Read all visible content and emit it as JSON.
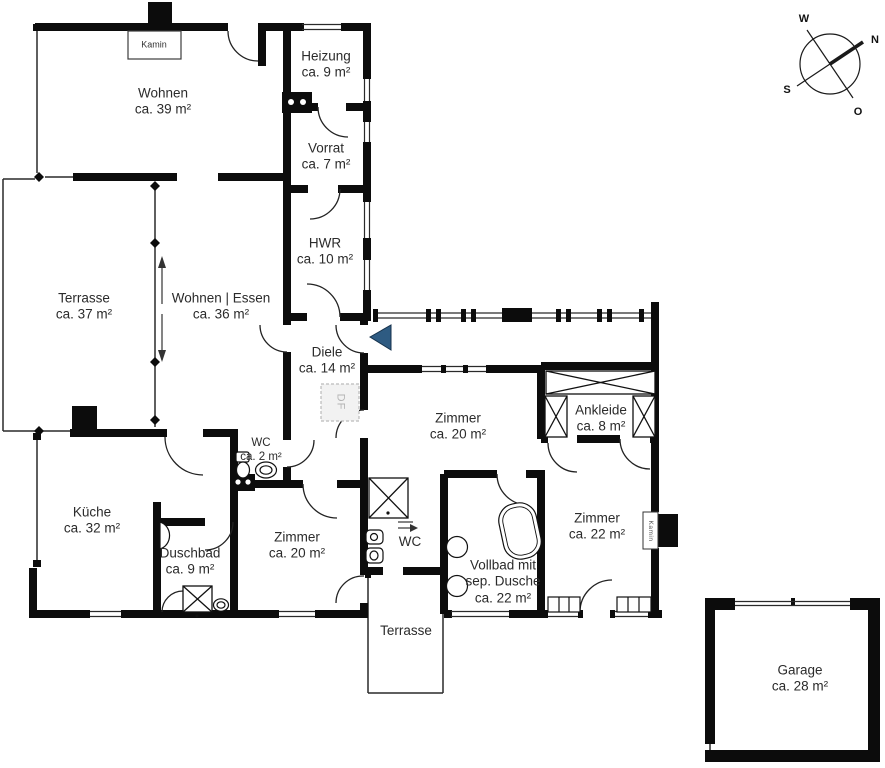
{
  "plan": {
    "compass": {
      "w": "W",
      "n": "N",
      "s": "S",
      "o": "O"
    },
    "rooms": {
      "wohnen": {
        "name": "Wohnen",
        "area": "ca. 39 m²"
      },
      "heizung": {
        "name": "Heizung",
        "area": "ca. 9 m²"
      },
      "vorrat": {
        "name": "Vorrat",
        "area": "ca. 7 m²"
      },
      "hwr": {
        "name": "HWR",
        "area": "ca. 10 m²"
      },
      "terrasse_links": {
        "name": "Terrasse",
        "area": "ca. 37 m²"
      },
      "wohnen_essen": {
        "name": "Wohnen | Essen",
        "area": "ca. 36 m²"
      },
      "diele": {
        "name": "Diele",
        "area": "ca. 14 m²"
      },
      "zimmer_mitte": {
        "name": "Zimmer",
        "area": "ca. 20 m²"
      },
      "ankleide": {
        "name": "Ankleide",
        "area": "ca. 8 m²"
      },
      "wc_klein": {
        "name": "WC",
        "area": "ca. 2 m²"
      },
      "kueche": {
        "name": "Küche",
        "area": "ca. 32 m²"
      },
      "duschbad": {
        "name": "Duschbad",
        "area": "ca. 9 m²"
      },
      "zimmer_unten": {
        "name": "Zimmer",
        "area": "ca. 20 m²"
      },
      "wc_mitte": {
        "name": "WC"
      },
      "vollbad": {
        "line1": "Vollbad mit",
        "line2": "sep. Dusche",
        "area": "ca. 22 m²"
      },
      "zimmer_rechts": {
        "name": "Zimmer",
        "area": "ca. 22 m²"
      },
      "terrasse_unten": {
        "name": "Terrasse"
      },
      "garage": {
        "name": "Garage",
        "area": "ca. 28 m²"
      }
    },
    "annotations": {
      "kamin_box": "Kamin",
      "kamin_wall": "Kamin",
      "df": "DF"
    },
    "colors": {
      "entry_arrow": "#2e5b82",
      "wall": "#0c0c0c"
    }
  }
}
